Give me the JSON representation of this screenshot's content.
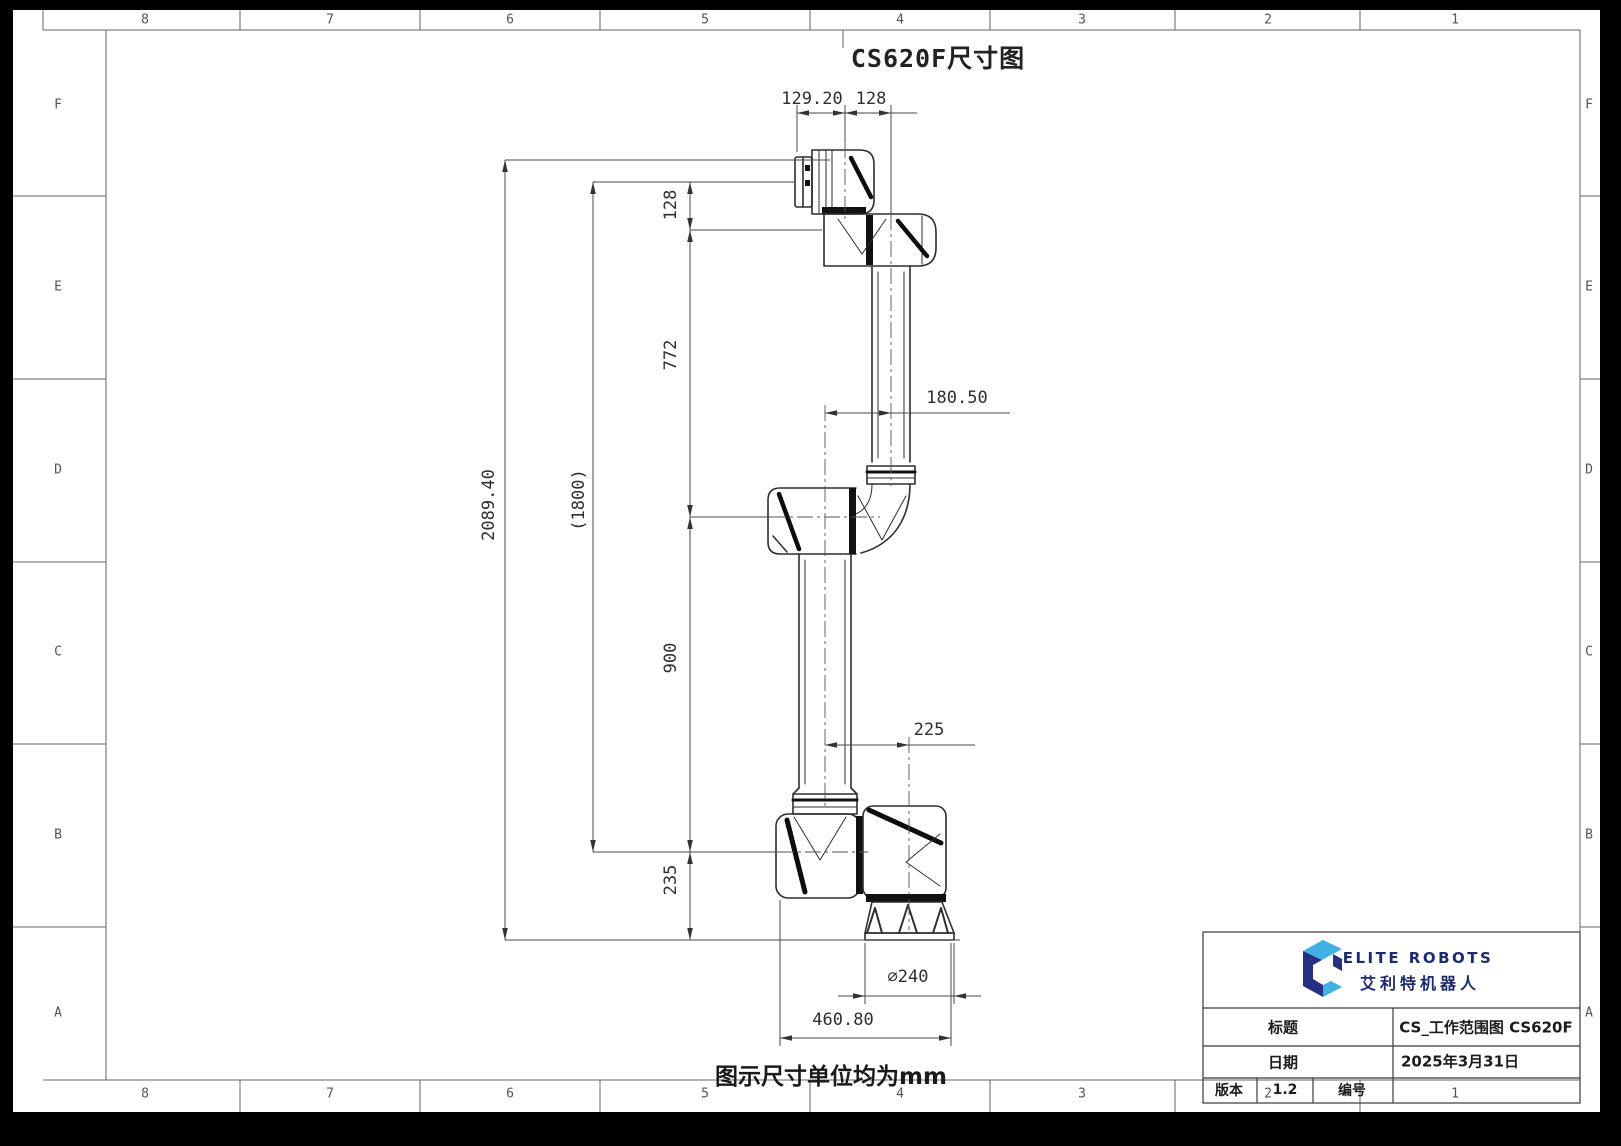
{
  "sheet": {
    "title": "CS620F尺寸图",
    "note": "图示尺寸单位均为mm"
  },
  "grid": {
    "columns": [
      "8",
      "7",
      "6",
      "5",
      "4",
      "3",
      "2",
      "1"
    ],
    "rows": [
      "F",
      "E",
      "D",
      "C",
      "B",
      "A"
    ]
  },
  "dimensions": {
    "flange_face_to_wrist_axis": "129.20",
    "wrist_axis_to_arm_center": "128",
    "flange_to_wrist2": "128",
    "wrist2_to_elbow": "772",
    "total_height": "2089.40",
    "shoulder_to_flange": "(1800)",
    "elbow_to_shoulder": "900",
    "shoulder_to_base": "235",
    "elbow_offset": "180.50",
    "shoulder_base_offset": "225",
    "base_diameter": "⌀240",
    "footprint_width": "460.80"
  },
  "title_block": {
    "brand_en": "ELITE ROBOTS",
    "brand_cn": "艾利特机器人",
    "title_label": "标题",
    "title_value": "CS_工作范围图 CS620F",
    "date_label": "日期",
    "date_value": "2025年3月31日",
    "version_label": "版本",
    "version_value": "1.2",
    "number_label": "编号",
    "number_value": "",
    "colors": {
      "navy": "#253083",
      "cyan": "#41b1e5"
    }
  }
}
